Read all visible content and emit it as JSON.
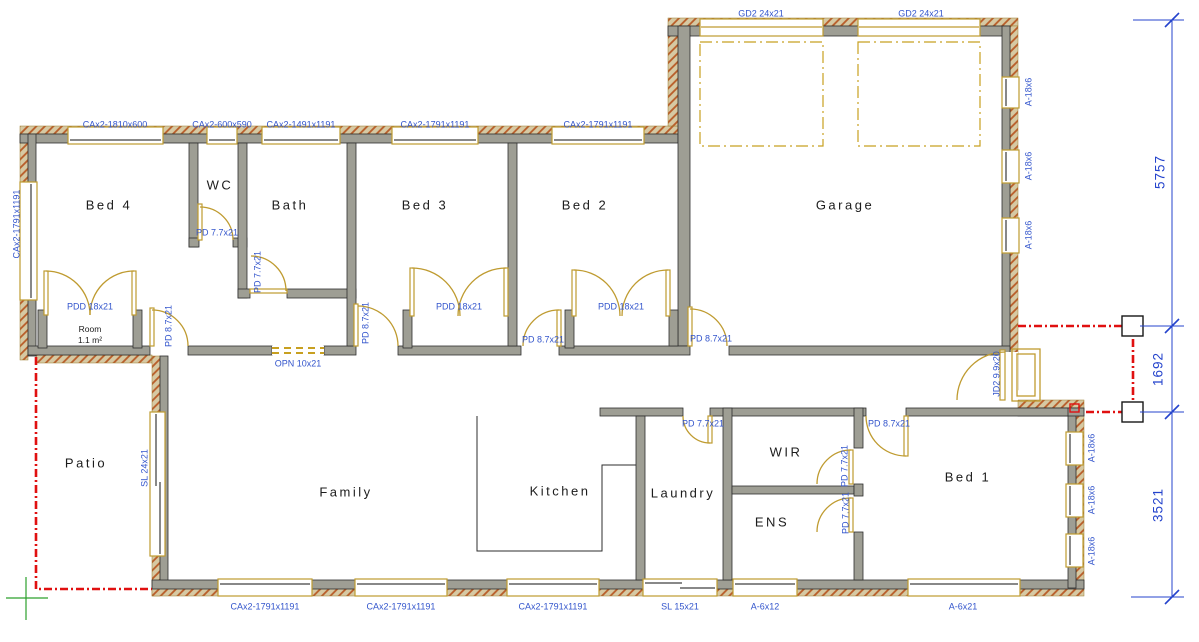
{
  "colors": {
    "wall_fill": "#9e9e94",
    "hatch_fill": "#d6c9a3",
    "hatch_stroke": "#b85c28",
    "frame_gold": "#bf9b30",
    "label_blue": "#3355cc",
    "dimension_blue": "#2443cc",
    "boundary_red": "#e01010",
    "marker_green": "#2ca02c"
  },
  "rooms": {
    "bed4": "Bed 4",
    "wc": "WC",
    "bath": "Bath",
    "bed3": "Bed 3",
    "bed2": "Bed 2",
    "garage": "Garage",
    "patio": "Patio",
    "family": "Family",
    "kitchen": "Kitchen",
    "laundry": "Laundry",
    "wir": "WIR",
    "ens": "ENS",
    "bed1": "Bed 1",
    "wardrobe": {
      "name": "Room",
      "area": "1.1 m²"
    }
  },
  "windows": {
    "top": [
      "CAx2-1810x600",
      "CAx2-600x590",
      "CAx2-1491x1191",
      "CAx2-1791x1191",
      "CAx2-1791x1191"
    ],
    "left": "CAx2-1791x1191",
    "garage_side": "A-18x6",
    "bed1_side": "A-18x6",
    "bottom": [
      "CAx2-1791x1191",
      "CAx2-1791x1191",
      "CAx2-1791x1191",
      "SL 15x21",
      "A-6x12",
      "A-6x21"
    ],
    "family_west": "SL 24x21"
  },
  "doors": {
    "garage_door": "GD2 24x21",
    "entry": "JD2 9.9x20",
    "double": "PDD 18x21",
    "single_87": "PD 8.7x21",
    "single_77": "PD 7.7x21",
    "opening": "OPN 10x21"
  },
  "dimensions": {
    "garage_side": "5757",
    "entry_porch": "1692",
    "bed1_side": "3521"
  }
}
